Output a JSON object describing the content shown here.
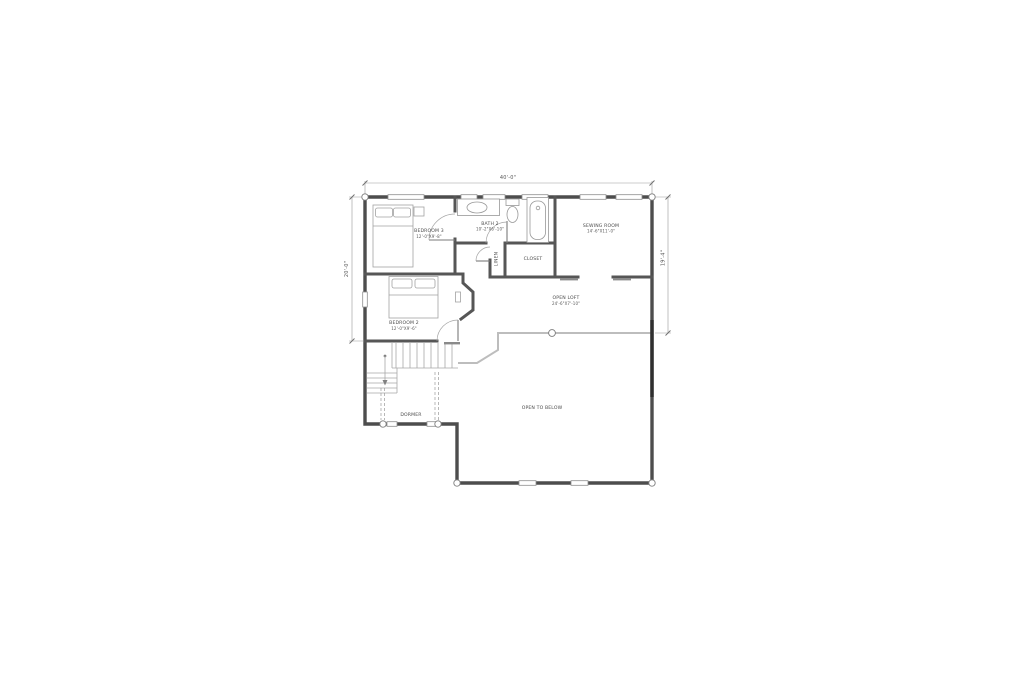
{
  "plan": {
    "type": "architectural-floor-plan",
    "floor": "second-floor",
    "colors": {
      "background": "#ffffff",
      "wall": "#4d4d4d",
      "light_line": "#a8a8a8",
      "text": "#4a4a4a"
    },
    "rooms": {
      "bedroom3": {
        "name": "BEDROOM 3",
        "size": "12'-0\"X9'-8\""
      },
      "bath2": {
        "name": "BATH 2",
        "size": "10'-2\"X6'-10\""
      },
      "sewing": {
        "name": "SEWING ROOM",
        "size": "14'-6\"X11'-0\""
      },
      "closet": {
        "name": "CLOSET"
      },
      "linen": {
        "name": "LINEN"
      },
      "bedroom2": {
        "name": "BEDROOM 2",
        "size": "12'-0\"X9'-6\""
      },
      "loft": {
        "name": "OPEN LOFT",
        "size": "24'-6\"X7'-10\""
      },
      "open_below": {
        "name": "OPEN TO BELOW"
      },
      "dormer": {
        "name": "DORMER"
      }
    },
    "dimensions": {
      "top": "40'-0\"",
      "left": "20'-0\"",
      "right": "19'-4\""
    }
  }
}
